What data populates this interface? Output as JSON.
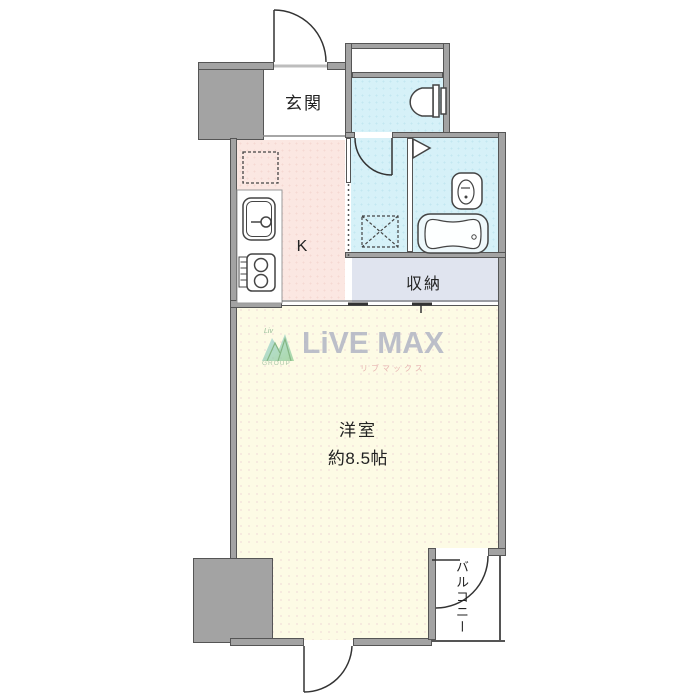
{
  "floorplan": {
    "rooms": {
      "entrance": {
        "label": "玄関"
      },
      "kitchen": {
        "label": "K"
      },
      "storage": {
        "label": "収納"
      },
      "western_room": {
        "label": "洋室",
        "area": "約8.5帖"
      },
      "balcony": {
        "label": "バルコニー"
      }
    },
    "fixtures": {
      "toilet": "toilet-icon",
      "bathtub": "bathtub-icon",
      "bath_sink": "bath-sink-icon",
      "kitchen_sink": "kitchen-sink-icon",
      "gas_stove": "gas-stove-icon",
      "washing_machine_space": "washing-machine-space-icon",
      "refrigerator_space": "refrigerator-space-icon",
      "entrance_door": "entrance-door-icon",
      "washroom_door": "washroom-door-icon",
      "bathroom_door": "bathroom-door-icon",
      "balcony_door": "balcony-door-icon",
      "south_door": "south-door-icon",
      "closet_sliding_door": "closet-sliding-door-icon"
    },
    "watermark": {
      "brand": "LiVE MAX",
      "brand_kana": "リブマックス",
      "icon_label": "Liv",
      "icon_sublabel": "GROUP"
    },
    "colors": {
      "wall": "#a3a3a3",
      "kitchen_floor": "#fbe7e2",
      "wet_area_floor": "#d6f1f8",
      "storage_floor": "#e0e4ef",
      "main_room_floor": "#fdfbe5",
      "logo_text": "#aeb2c4",
      "logo_kana": "#e3a8a8",
      "logo_green": "#86c98a"
    }
  }
}
